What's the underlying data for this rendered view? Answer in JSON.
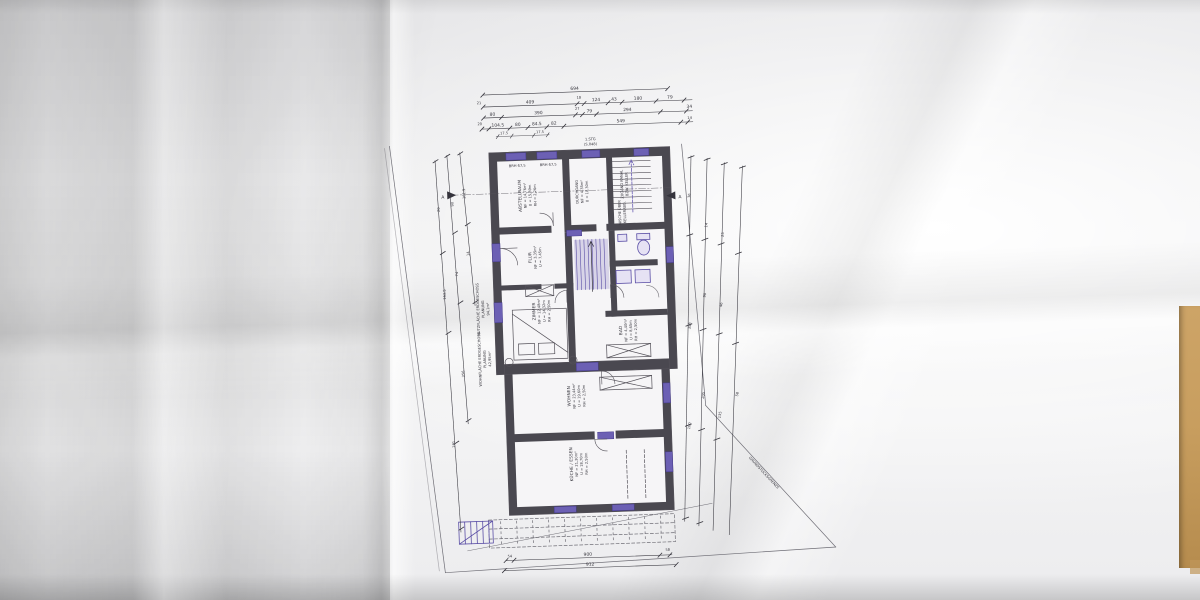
{
  "plan": {
    "title_note_1": "1.STG",
    "title_note_2": "(S.048)",
    "section_marker_left": "A",
    "section_marker_right": "A",
    "boundary_label": "GRUNDSTÜCKSGRENZE",
    "sill_label_1": "BRH 67,5",
    "sill_label_2": "BRH 67,5",
    "stair_core_label_1": "ZUGANG KANAL",
    "stair_core_label_2": "BZW. KELLER",
    "nische_label_1": "NISCHE ÜBER",
    "nische_label_2": "KELLERABG.",
    "area_note_1": {
      "l1": "NUTZFLÄCHE ERDGESCHOSS",
      "l2": "PLANUNG",
      "l3": "94,1m²"
    },
    "area_note_2": {
      "l1": "WOHNFLÄCHE ERDGESCHOSS",
      "l2": "PLANUNG",
      "l3": "42,95m²"
    },
    "rooms": {
      "abstellraum": {
        "name": "ABSTELLRAUM",
        "l1": "NF = 14,76m²",
        "l2": "U = 15,39m",
        "l3": "RH = 2,26m"
      },
      "durchgang": {
        "name": "DURCHGANG",
        "l1": "NF = 4,35m²",
        "l2": "U = 10,30m"
      },
      "flur": {
        "name": "FLUR",
        "l1": "NF = 3,35m²",
        "l2": "U = 7,45m"
      },
      "zimmer": {
        "name": "ZIMMER",
        "l1": "NF = 12,48m²",
        "l2": "U = 14,32m",
        "l3": "RH = 2,50m"
      },
      "bad": {
        "name": "BAD",
        "l1": "NF = 4,40m²",
        "l2": "U = 8,65m",
        "l3": "RH = 2,50m"
      },
      "wohnen": {
        "name": "WOHNEN",
        "l1": "NF = 23,44m²",
        "l2": "U = 19,60m",
        "l3": "RH = 2,50m"
      },
      "kueche": {
        "name": "KÜCHE / ESSEN",
        "l1": "NF = 21,30m²",
        "l2": "U = 18,70m",
        "l3": "RH = 2,50m"
      }
    },
    "dims": {
      "top1": "694",
      "top2": [
        "21",
        "409",
        "18",
        "124",
        "43",
        "180",
        "79"
      ],
      "top3": [
        "80",
        "390",
        "27",
        "79",
        "294",
        "34"
      ],
      "top4": [
        "20",
        "104.5",
        "80",
        "84.5",
        "82",
        "549",
        "14"
      ],
      "top_sub": [
        "17.5",
        "17.5"
      ],
      "bottom1": [
        "54",
        "900",
        "58"
      ],
      "bottom2": "912",
      "left": [
        "161.5",
        "14",
        "90",
        "74",
        "356",
        "20",
        "163.5",
        "191"
      ],
      "right": [
        "36",
        "100",
        "358",
        "205",
        "90",
        "14",
        "135",
        "46",
        "25",
        "58"
      ]
    },
    "colors": {
      "wall": "#4a4850",
      "accent_purple": "#5b4fa6",
      "table": "#c89e5f"
    }
  }
}
